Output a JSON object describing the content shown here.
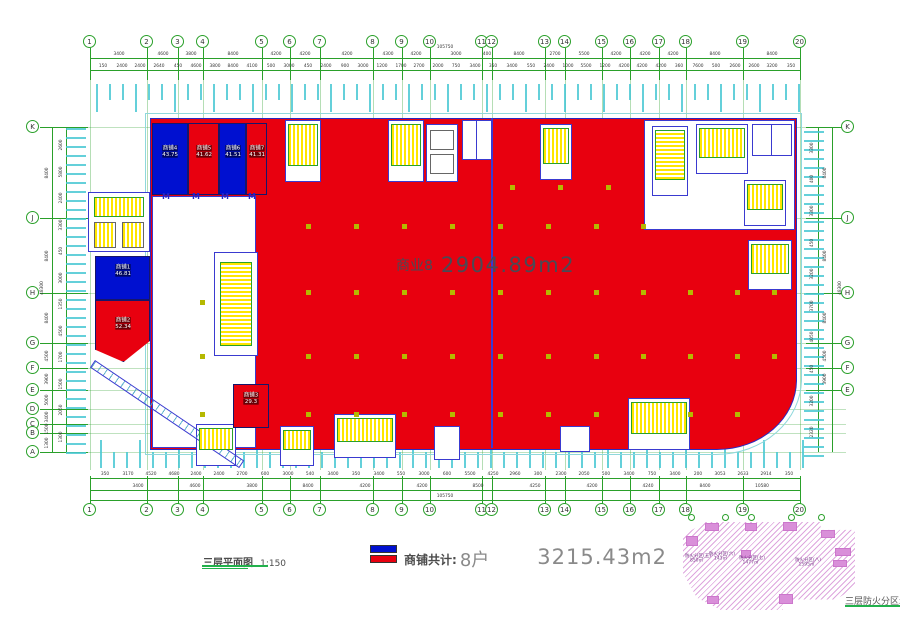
{
  "drawing": {
    "main_area": {
      "name": "商业8",
      "area": "2904.89m2"
    },
    "shops": [
      {
        "name": "商铺1",
        "area": "46.81",
        "fill": "blue"
      },
      {
        "name": "商铺2",
        "area": "52.34",
        "fill": "red"
      },
      {
        "name": "商铺3",
        "area": "29.3",
        "fill": "red"
      },
      {
        "name": "商铺4",
        "area": "43.75",
        "fill": "blue"
      },
      {
        "name": "商铺5",
        "area": "41.62",
        "fill": "red"
      },
      {
        "name": "商铺6",
        "area": "41.51",
        "fill": "blue"
      },
      {
        "name": "商铺7",
        "area": "41.31",
        "fill": "red"
      }
    ],
    "door_symbol": "M"
  },
  "legend": {
    "summary_label": "商铺共计:",
    "count": "8户",
    "total_area": "3215.43m2"
  },
  "title_block": {
    "plan_title": "三层平面图",
    "plan_scale": "1:150"
  },
  "grid": {
    "top_bubbles": [
      "1",
      "2",
      "3",
      "4",
      "5",
      "6",
      "7",
      "8",
      "9",
      "10",
      "11",
      "12",
      "13",
      "14",
      "15",
      "16",
      "17",
      "18",
      "19",
      "20"
    ],
    "left_bubbles": [
      "K",
      "J",
      "H",
      "G",
      "F",
      "E",
      "D",
      "C",
      "B",
      "A"
    ],
    "right_bubbles": [
      "K",
      "J",
      "H",
      "G",
      "F",
      "E"
    ],
    "overall_width": "105750",
    "overall_height": "48300"
  },
  "dimensions": {
    "top_row1": [
      "3400",
      "4600",
      "3800",
      "8400",
      "4200",
      "4200",
      "4200",
      "4300",
      "4200",
      "3000",
      "400",
      "8400",
      "2700",
      "5500",
      "4200",
      "4200",
      "4200",
      "8400",
      "8400"
    ],
    "top_row2": [
      "150",
      "2400",
      "2400",
      "2640",
      "450",
      "4600",
      "3800",
      "8400",
      "4100",
      "500",
      "3000",
      "450",
      "2400",
      "900",
      "3000",
      "1200",
      "1700",
      "2700",
      "2000",
      "750",
      "3400",
      "350",
      "3400",
      "550",
      "2400",
      "1000",
      "5500",
      "1200",
      "4200",
      "4200",
      "4200",
      "360",
      "7600",
      "500",
      "2600",
      "2600",
      "3200",
      "350"
    ],
    "bottom_row1": [
      "350",
      "3170",
      "4520",
      "4680",
      "2400",
      "2400",
      "2700",
      "600",
      "3000",
      "540",
      "3400",
      "350",
      "3400",
      "550",
      "3000",
      "600",
      "5500",
      "4250",
      "2960",
      "300",
      "2300",
      "2050",
      "500",
      "3400",
      "750",
      "3400",
      "200",
      "3053",
      "2633",
      "2914",
      "350"
    ],
    "bottom_row2": [
      "3400",
      "4600",
      "3800",
      "8400",
      "4200",
      "4200",
      "8500",
      "4250",
      "4200",
      "4240",
      "8400",
      "10580"
    ],
    "left_outer": [
      "8400",
      "8400",
      "8400",
      "4500",
      "3900",
      "5000",
      "3400",
      "1500",
      "1300"
    ],
    "left_inner": [
      "2600",
      "5800",
      "2400",
      "3300",
      "450",
      "3000",
      "1350",
      "4500",
      "1700",
      "1500",
      "2050",
      "1300"
    ],
    "right_outer": [
      "8400",
      "8400",
      "8400",
      "4500",
      "3900"
    ],
    "right_inner": [
      "3300",
      "400",
      "3300",
      "450",
      "3200",
      "3700",
      "4050",
      "450",
      "3200",
      "2320"
    ]
  },
  "fire_diagram": {
    "caption": "三层防火分区示",
    "zones": [
      {
        "name": "防火分区(五)",
        "area": "850㎡"
      },
      {
        "name": "防火分区(六)",
        "area": "143㎡"
      },
      {
        "name": "防火分区(七)",
        "area": "1477㎡"
      },
      {
        "name": "防火分区(八)",
        "area": "1595㎡"
      }
    ]
  },
  "colors": {
    "shop_red": "#e8000f",
    "shop_blue": "#0010d0",
    "grid_green": "#2aa02a",
    "tick_cyan": "#49c8d4",
    "stair_yellow": "#ffe600",
    "outline_blue": "#3a3ad0",
    "hatch_pink": "#cc77cc",
    "column_olive": "#b5b800"
  }
}
